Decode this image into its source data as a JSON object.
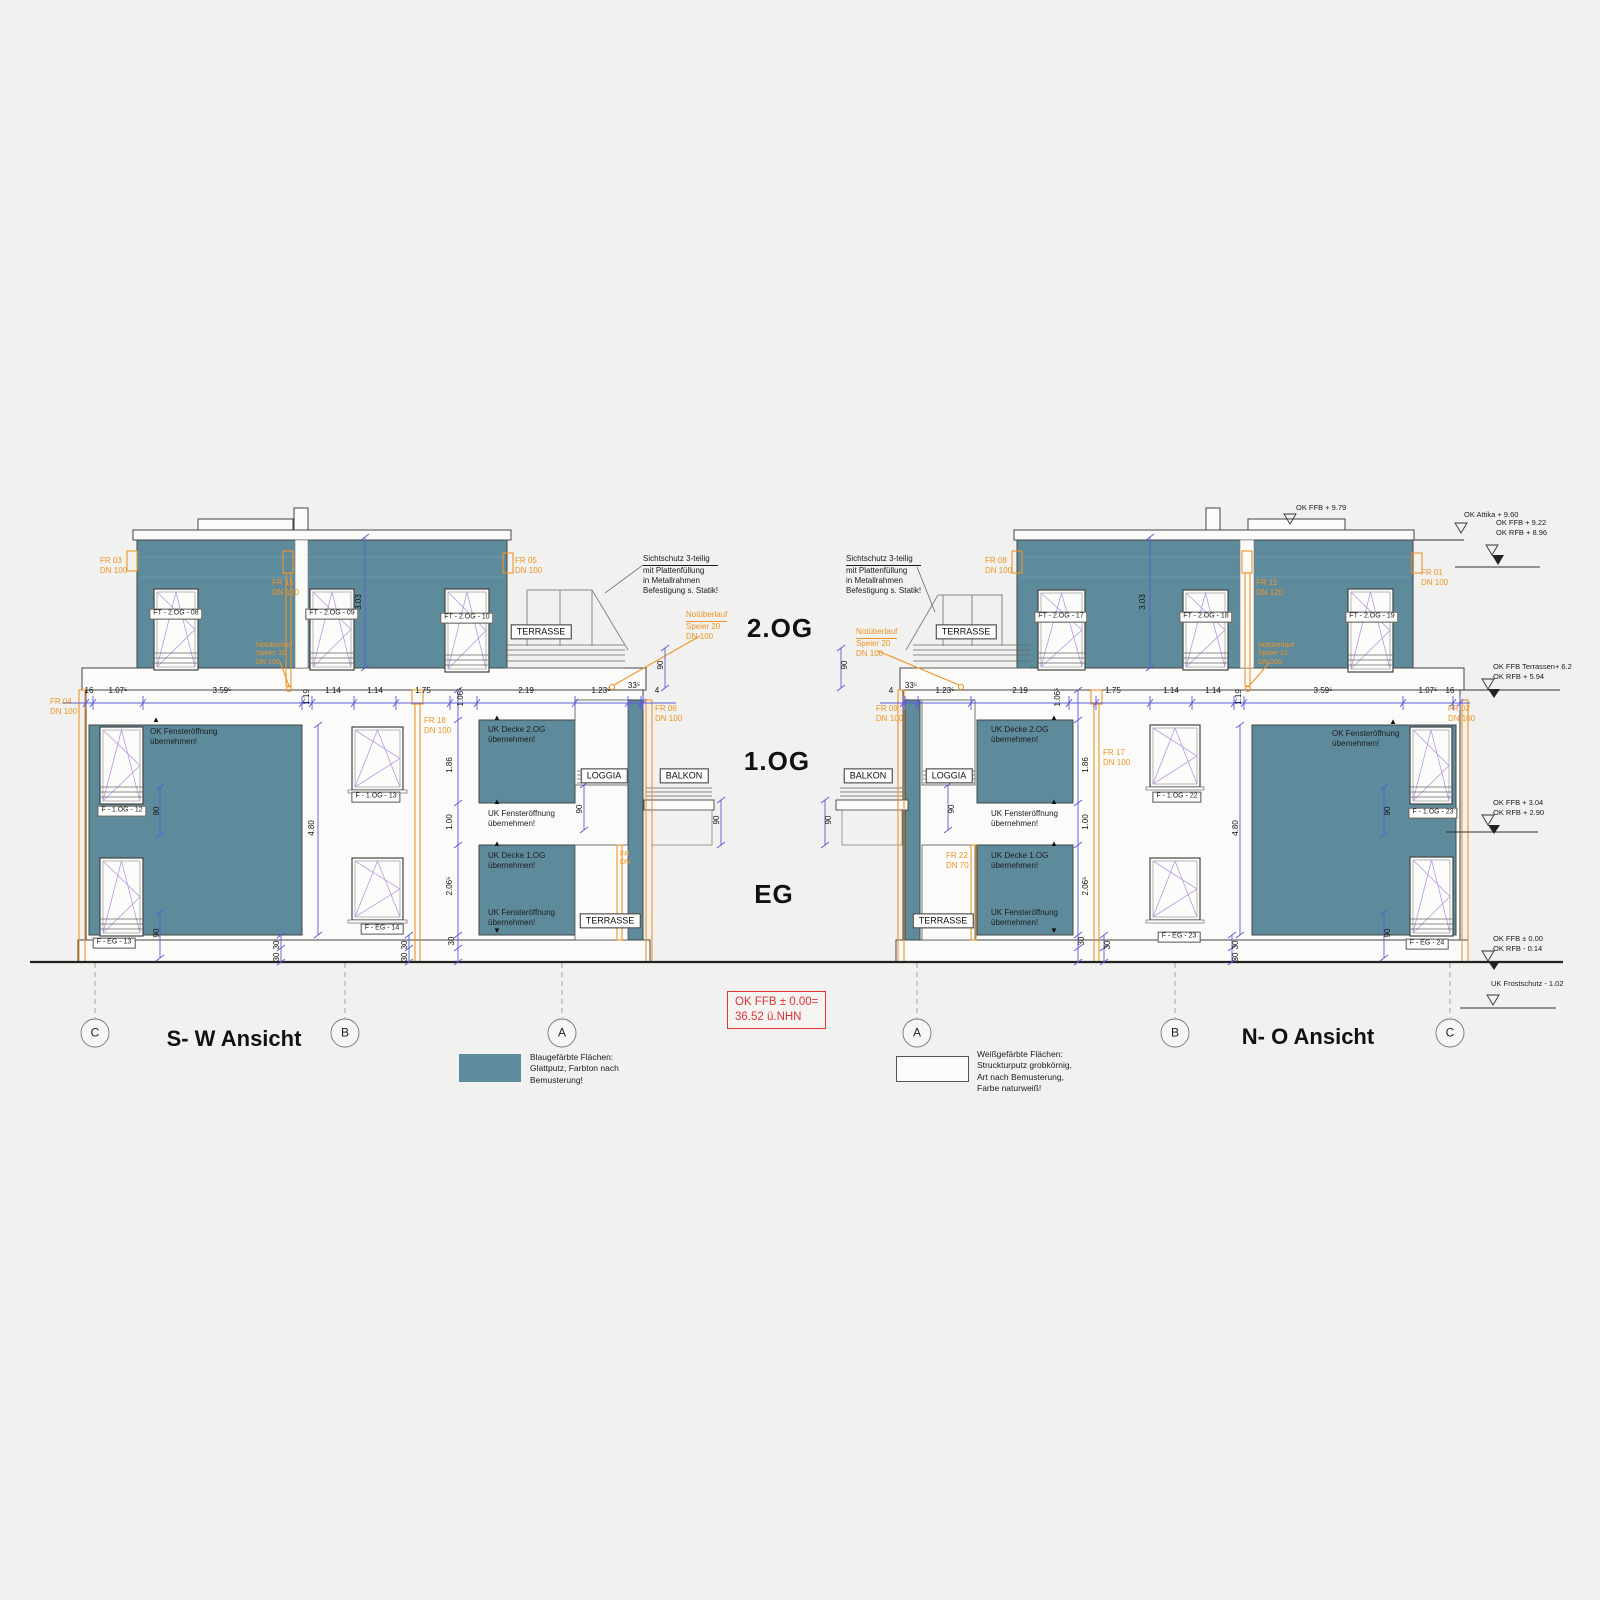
{
  "colors": {
    "facade_blue": "#5e8b9c",
    "annotation_orange": "#ef9426",
    "dim_line_blue": "#5b5bd6",
    "window_symbol_violet": "#b79be0",
    "note_red": "#e03434",
    "line_dark": "#3a3a3a",
    "background": "#f1f1ef"
  },
  "view_titles": {
    "left": "S- W Ansicht",
    "right": "N- O Ansicht"
  },
  "floor_labels": {
    "og2": "2.OG",
    "og1": "1.OG",
    "eg": "EG"
  },
  "grid_bubbles": {
    "left": [
      "C",
      "B",
      "A"
    ],
    "right": [
      "A",
      "B",
      "C"
    ]
  },
  "red_note": {
    "line1": "OK FFB ± 0.00=",
    "line2": "36.52 ü.NHN"
  },
  "legend_blue": {
    "lines": [
      "Blaugefärbte Flächen:",
      "Glattputz, Farbton nach",
      "Bemusterung!"
    ]
  },
  "legend_white": {
    "lines": [
      "Weißgefärbte Flächen:",
      "Struckturputz grobkörnig,",
      "Art nach Bemusterung,",
      "Farbe naturweiß!"
    ]
  },
  "window_labels": {
    "w08": "FT - 2.OG - 08",
    "w09": "FT - 2.OG - 09",
    "w10": "FT - 2.OG - 10",
    "w12": "F - 1.OG - 12",
    "w13og": "F - 1.OG - 13",
    "w13eg": "F - EG - 13",
    "w14": "F - EG - 14",
    "w17": "FT - 2.OG - 17",
    "w18": "FT - 2.OG - 18",
    "w19": "FT - 2.OG - 19",
    "w22": "F - 1.OG - 22",
    "w23og": "F - 1.OG - 23",
    "w23eg": "F - EG - 23",
    "w24": "F - EG - 24"
  },
  "room_labels": {
    "terrasse": "TERRASSE",
    "loggia": "LOGGIA",
    "balkon": "BALKON"
  },
  "dims": {
    "left_h": [
      "16",
      "1.07⁵",
      "3.59⁵",
      "1.19",
      "1.14",
      "1.14",
      "1.75",
      "1.06⁵",
      "2.19",
      "1.23⁵",
      "33⁵",
      "4"
    ],
    "right_h": [
      "4",
      "33⁵",
      "1.23⁵",
      "2.19",
      "1.06⁵",
      "1.75",
      "1.14",
      "1.14",
      "1.19",
      "3.59⁵",
      "1.07⁵",
      "16"
    ],
    "v_303": "3.03",
    "v_480": "4.80",
    "v_186": "1.86",
    "v_100": "1.00",
    "v_2065": "2.06⁵",
    "v_30": "30",
    "v_90": "90"
  },
  "pipe_labels": {
    "fr01": [
      "FR 01",
      "DN 100"
    ],
    "fr02": [
      "FR 02",
      "DN 100"
    ],
    "fr03": [
      "FR 03",
      "DN 100"
    ],
    "fr04": [
      "FR 04",
      "DN 100"
    ],
    "fr05": [
      "FR 05",
      "DN 100"
    ],
    "fr06": [
      "FR 06",
      "DN 100"
    ],
    "fr08": [
      "FR 08",
      "DN 100"
    ],
    "fr09": [
      "FR 09",
      "DN 100"
    ],
    "fr11": [
      "FR 11",
      "DN 120"
    ],
    "fr15": [
      "FR 15",
      "DN 100"
    ],
    "fr17": [
      "FR 17",
      "DN 100"
    ],
    "fr18": [
      "FR 18",
      "DN 100"
    ],
    "fr22": [
      "FR 22",
      "DN 70"
    ],
    "fr_cut": [
      "FR",
      "DN"
    ]
  },
  "overflow_notes": {
    "speier20": [
      "Notüberlauf",
      "Speier  20",
      "DN 100"
    ],
    "speier12": [
      "Notüberlauf",
      "Speier 12",
      "DN 100"
    ],
    "speier10": [
      "Notüberlauf",
      "Speier 10",
      "DN 100"
    ]
  },
  "annotations": {
    "ok_fenster": [
      "OK Fensteröffnung",
      "übernehmen!"
    ],
    "uk_decke2": [
      "UK Decke 2.OG",
      "übernehmen!"
    ],
    "uk_fenster": [
      "UK Fensteröffnung",
      "übernehmen!"
    ],
    "uk_decke1": [
      "UK Decke 1.OG",
      "übernehmen!"
    ],
    "sichtschutz": [
      "Sichtschutz 3-teilig",
      "mit Plattenfüllung",
      "in Metallrahmen",
      "Befestigung s. Statik!"
    ]
  },
  "level_marks": {
    "ffb979": "OK FFB + 9.79",
    "attika960": "OK Attika + 9.60",
    "ffb922": "OK FFB + 9.22",
    "rfb896": "OK RFB + 8.96",
    "ffb_terr": "OK FFB Terrassen+ 6.2",
    "rfb594": "OK RFB + 5.94",
    "ffb304": "OK FFB + 3.04",
    "rfb290": "OK RFB + 2.90",
    "ffb000": "OK FFB ± 0.00",
    "rfb014": "OK RFB - 0.14",
    "frost": "UK Frostschutz - 1.02"
  },
  "symbols": {
    "tri_up": "▲",
    "tri_down": "▼"
  }
}
